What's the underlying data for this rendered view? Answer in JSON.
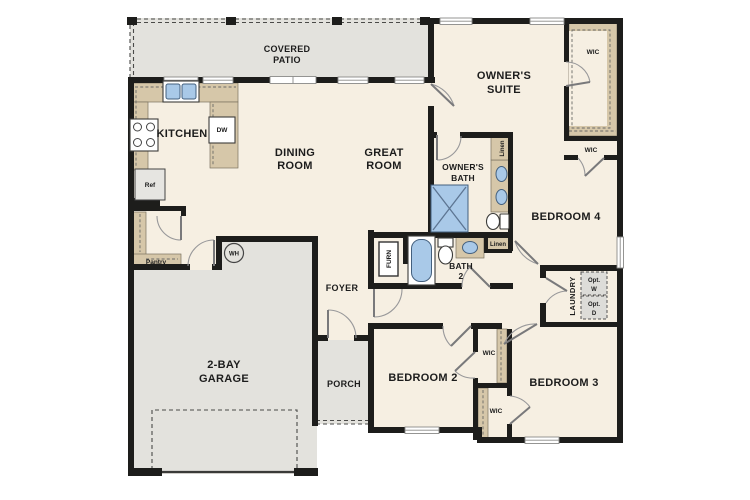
{
  "palette": {
    "wall": "#1d1d1b",
    "floor": "#f6efe2",
    "outdoor": "#e3e2dd",
    "casework": "#d6c7a9",
    "fixture_blue": "#a9c9e8",
    "door_swing": "#98989a",
    "label_text": "#1c1c1c",
    "opt_box": "#dddcd8"
  },
  "labels": {
    "covered_patio": [
      "COVERED",
      "PATIO"
    ],
    "kitchen": "KITCHEN",
    "dining_room": [
      "DINING",
      "ROOM"
    ],
    "great_room": [
      "GREAT",
      "ROOM"
    ],
    "owners_suite": [
      "OWNER'S",
      "SUITE"
    ],
    "owners_bath": [
      "OWNER'S",
      "BATH"
    ],
    "bedroom4": "BEDROOM 4",
    "bath2": [
      "BATH",
      "2"
    ],
    "foyer": "FOYER",
    "laundry": "LAUNDRY",
    "garage": [
      "2-BAY",
      "GARAGE"
    ],
    "porch": "PORCH",
    "bedroom2": "BEDROOM 2",
    "bedroom3": "BEDROOM 3",
    "pantry": "Pantry",
    "wic": "WIC",
    "linen": "Linen",
    "ref": "Ref",
    "dw": "DW",
    "wh": "WH",
    "furn": "FURN",
    "opt_washer": [
      "Opt.",
      "W"
    ],
    "opt_dryer": [
      "Opt.",
      "D"
    ]
  }
}
